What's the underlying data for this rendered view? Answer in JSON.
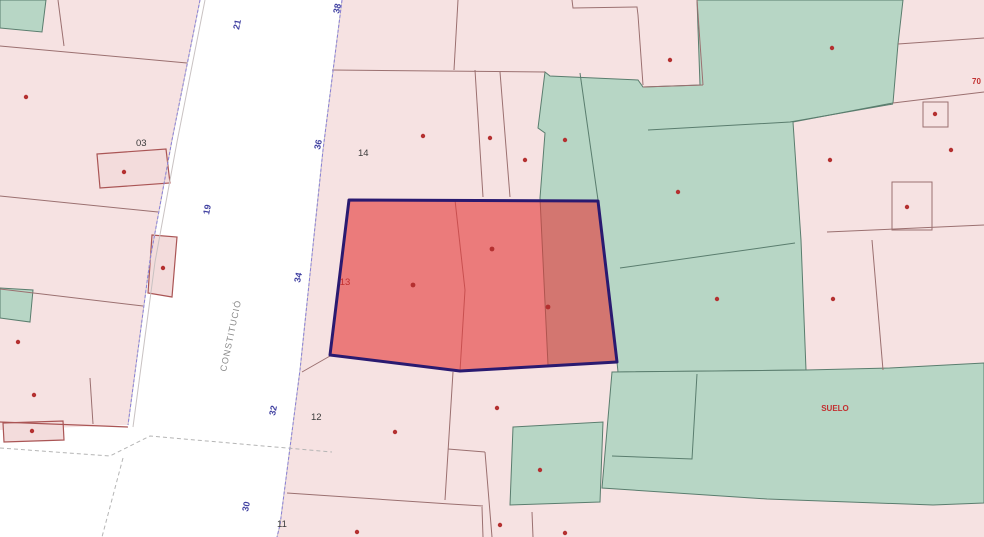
{
  "street": {
    "name": "CONSTITUCIÓ"
  },
  "street_numbers": {
    "n21": "21",
    "n19": "19",
    "n38": "38",
    "n36": "36",
    "n34": "34",
    "n32": "32",
    "n30": "30"
  },
  "parcel_labels": {
    "p03": "03",
    "p14": "14",
    "p12": "12",
    "p11": "11"
  },
  "highlight": {
    "label": "13"
  },
  "green_zone": {
    "label": "SUELO"
  },
  "edge_label": "70",
  "colors": {
    "parcel_pink": "#f6e2e2",
    "parcel_green": "#b7d6c5",
    "street_white": "#ffffff",
    "highlight_fill": "#e43c3c",
    "highlight_border": "#2a1a70",
    "boundary_pink_line": "#9b7070",
    "boundary_green_line": "#5a7d6e",
    "street_number_blue": "#3f3fa0",
    "parcel_label_black": "#3a3a3a",
    "red_label": "#c23030"
  }
}
